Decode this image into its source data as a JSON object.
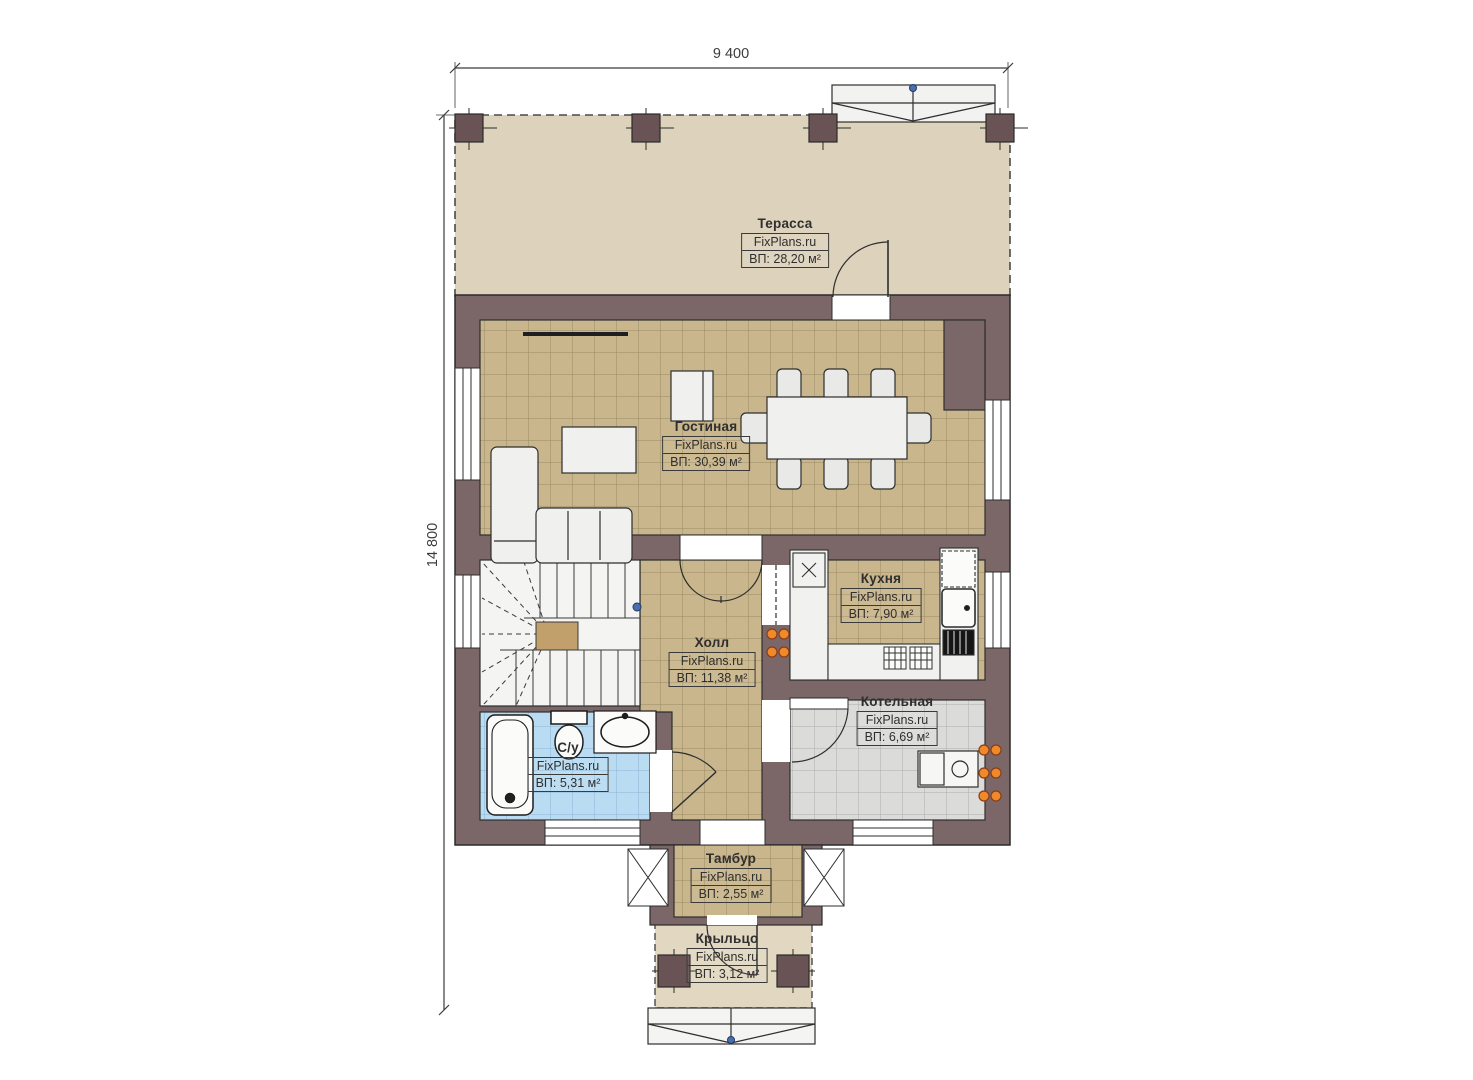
{
  "title": "План первого этажа",
  "brand": "FixPlans.ru",
  "dimensions": {
    "top": "9 400",
    "left": "14 800"
  },
  "rooms": [
    {
      "id": "terrace",
      "name": "Терасса",
      "brand": "FixPlans.ru",
      "area": "ВП: 28,20 м²"
    },
    {
      "id": "living",
      "name": "Гостиная",
      "brand": "FixPlans.ru",
      "area": "ВП: 30,39 м²"
    },
    {
      "id": "kitchen",
      "name": "Кухня",
      "brand": "FixPlans.ru",
      "area": "ВП: 7,90 м²"
    },
    {
      "id": "hall",
      "name": "Холл",
      "brand": "FixPlans.ru",
      "area": "ВП: 11,38 м²"
    },
    {
      "id": "boiler",
      "name": "Котельная",
      "brand": "FixPlans.ru",
      "area": "ВП: 6,69 м²"
    },
    {
      "id": "bathroom",
      "name": "С/у",
      "brand": "FixPlans.ru",
      "area": "ВП: 5,31 м²"
    },
    {
      "id": "vestibule",
      "name": "Тамбур",
      "brand": "FixPlans.ru",
      "area": "ВП: 2,55 м²"
    },
    {
      "id": "porch",
      "name": "Крыльцо",
      "brand": "FixPlans.ru",
      "area": "ВП: 3,12 м²"
    }
  ],
  "colors": {
    "wall": "#7b6768",
    "column": "#6a5354",
    "terrace_floor": "#ddd2bc",
    "porch_floor": "#e2d8c2",
    "tile_tan": "#c9b68c",
    "tile_tan_line": "#9b8a63",
    "bath_floor": "#b9dcf2",
    "bath_line": "#8cb4d6",
    "boiler_floor": "#dbdbd9",
    "boiler_line": "#aeaeac",
    "radiator_orange": "#ef8a2a",
    "marker_blue": "#4a6fae",
    "ink": "#2e2e2e"
  }
}
